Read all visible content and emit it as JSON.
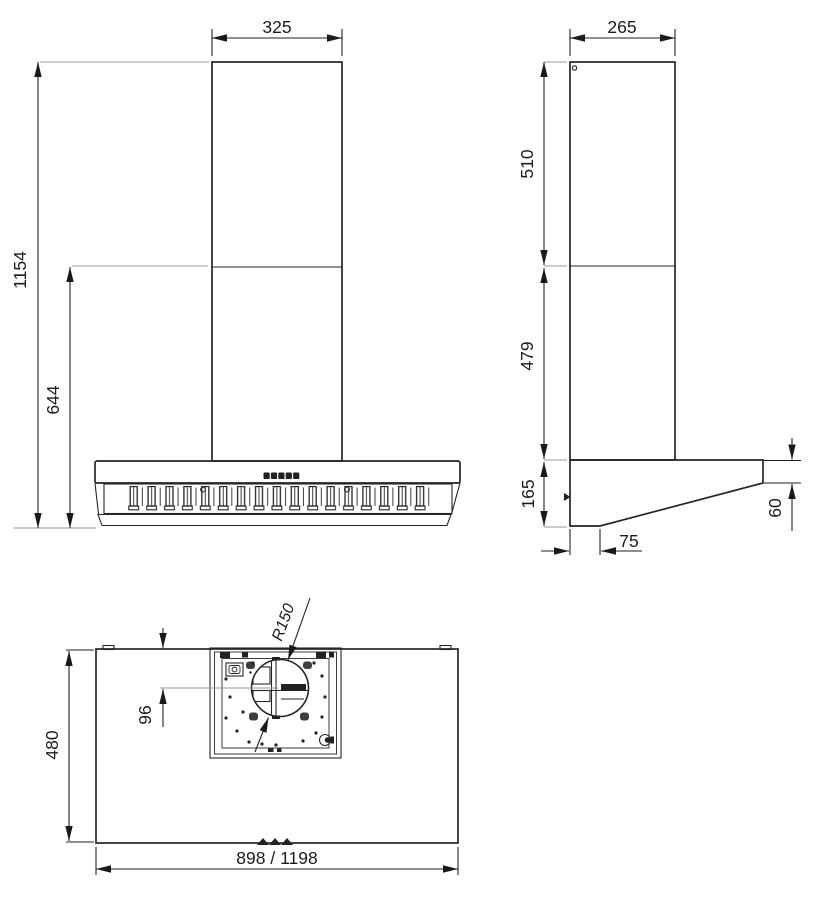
{
  "colors": {
    "ink": "#262626",
    "extension_line": "#9a9a9a"
  },
  "front_view": {
    "chimney_width": "325",
    "total_height": "1154",
    "hood_height": "644"
  },
  "side_view": {
    "chimney_depth": "265",
    "upper_chimney_height": "510",
    "lower_chimney_height": "479",
    "body_rear_height": "165",
    "body_front_height": "60",
    "bottom_front_offset": "75"
  },
  "plan_view": {
    "depth": "480",
    "width_options": "898 / 1198",
    "outlet_radius": "R150",
    "outlet_center_offset": "96"
  }
}
